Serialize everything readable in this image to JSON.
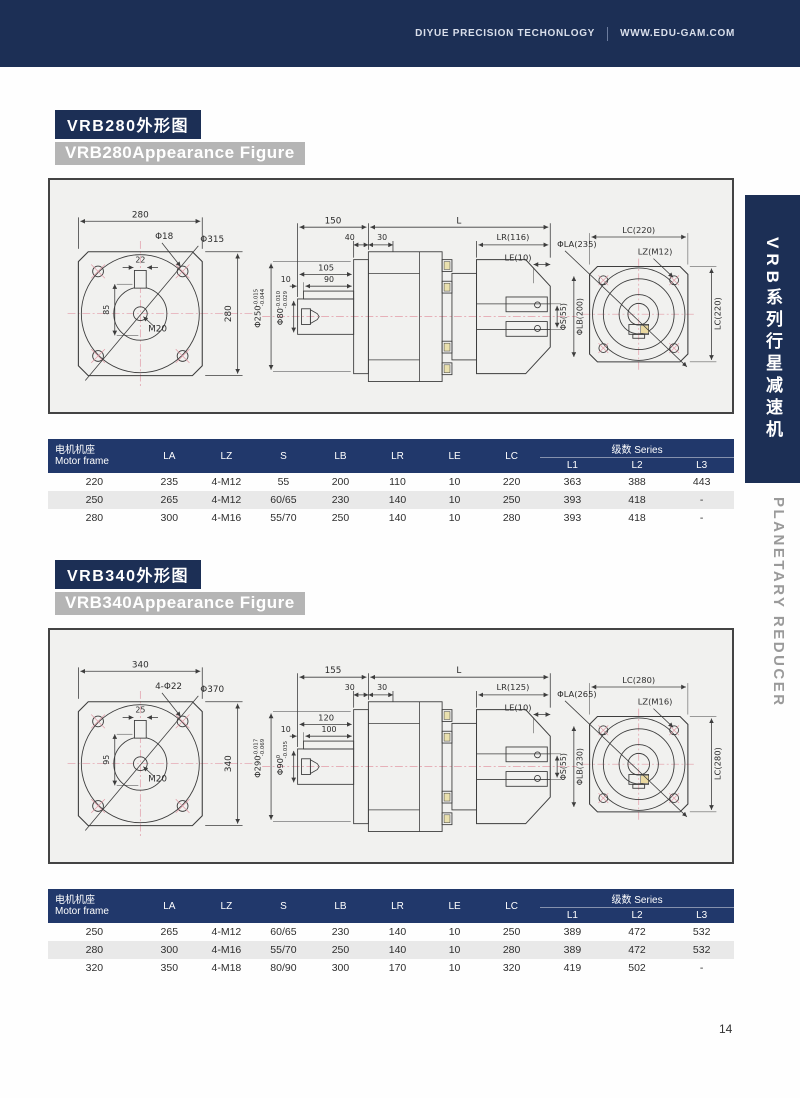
{
  "colors": {
    "navy": "#1c2f55",
    "table_navy": "#21386b",
    "gray_badge": "#b5b5b5",
    "draw_bg": "#f1f1ef"
  },
  "topbar": {
    "company": "DIYUE PRECISION TECHONLOGY",
    "website": "WWW.EDU-GAM.COM"
  },
  "sidebar": {
    "series_cn": "VRB系列行星减速机",
    "series_en": "PLANETARY REDUCER"
  },
  "page_number": "14",
  "table_header": {
    "motor_cn": "电机机座",
    "motor_en": "Motor frame",
    "cols": [
      "LA",
      "LZ",
      "S",
      "LB",
      "LR",
      "LE",
      "LC"
    ],
    "series_cn": "级数",
    "series_en": "Series",
    "sub": [
      "L1",
      "L2",
      "L3"
    ]
  },
  "sections": [
    {
      "title_cn": "VRB280外形图",
      "title_en": "VRB280Appearance Figure",
      "figure": {
        "front": {
          "width": "280",
          "height": "280",
          "hole": "Φ18",
          "circle": "Φ315",
          "key_w": "22",
          "key_h": "85",
          "thread": "M20"
        },
        "side": {
          "left_len": "150",
          "total_len": "L",
          "d1": "40",
          "d2": "30",
          "lr": "LR(116)",
          "le": "LE(10)",
          "hub": "105",
          "key_off": "10",
          "key_len": "90",
          "shaft_dia": "Φ80",
          "shaft_tol_top": "-0.010",
          "shaft_tol_bot": "-0.029",
          "pilot_dia": "Φ250",
          "pilot_tol_top": "-0.015",
          "pilot_tol_bot": "-0.044",
          "s": "ΦS(55)",
          "lb": "ΦLB(200)"
        },
        "rear": {
          "lc_top": "LC(220)",
          "la": "ΦLA(235)",
          "lz": "LZ(M12)",
          "lc_right": "LC(220)"
        }
      },
      "rows": [
        [
          "220",
          "235",
          "4-M12",
          "55",
          "200",
          "110",
          "10",
          "220",
          "363",
          "388",
          "443"
        ],
        [
          "250",
          "265",
          "4-M12",
          "60/65",
          "230",
          "140",
          "10",
          "250",
          "393",
          "418",
          "-"
        ],
        [
          "280",
          "300",
          "4-M16",
          "55/70",
          "250",
          "140",
          "10",
          "280",
          "393",
          "418",
          "-"
        ]
      ]
    },
    {
      "title_cn": "VRB340外形图",
      "title_en": "VRB340Appearance Figure",
      "figure": {
        "front": {
          "width": "340",
          "height": "340",
          "hole": "4-Φ22",
          "circle": "Φ370",
          "key_w": "25",
          "key_h": "95",
          "thread": "M20"
        },
        "side": {
          "left_len": "155",
          "total_len": "L",
          "d1": "30",
          "d2": "30",
          "lr": "LR(125)",
          "le": "LE(10)",
          "hub": "120",
          "key_off": "10",
          "key_len": "100",
          "shaft_dia": "Φ90",
          "shaft_tol_top": "0",
          "shaft_tol_bot": "-0.035",
          "pilot_dia": "Φ290",
          "pilot_tol_top": "-0.017",
          "pilot_tol_bot": "-0.069",
          "s": "ΦS(55)",
          "lb": "ΦLB(230)"
        },
        "rear": {
          "lc_top": "LC(280)",
          "la": "ΦLA(265)",
          "lz": "LZ(M16)",
          "lc_right": "LC(280)"
        }
      },
      "rows": [
        [
          "250",
          "265",
          "4-M12",
          "60/65",
          "230",
          "140",
          "10",
          "250",
          "389",
          "472",
          "532"
        ],
        [
          "280",
          "300",
          "4-M16",
          "55/70",
          "250",
          "140",
          "10",
          "280",
          "389",
          "472",
          "532"
        ],
        [
          "320",
          "350",
          "4-M18",
          "80/90",
          "300",
          "170",
          "10",
          "320",
          "419",
          "502",
          "-"
        ]
      ]
    }
  ]
}
